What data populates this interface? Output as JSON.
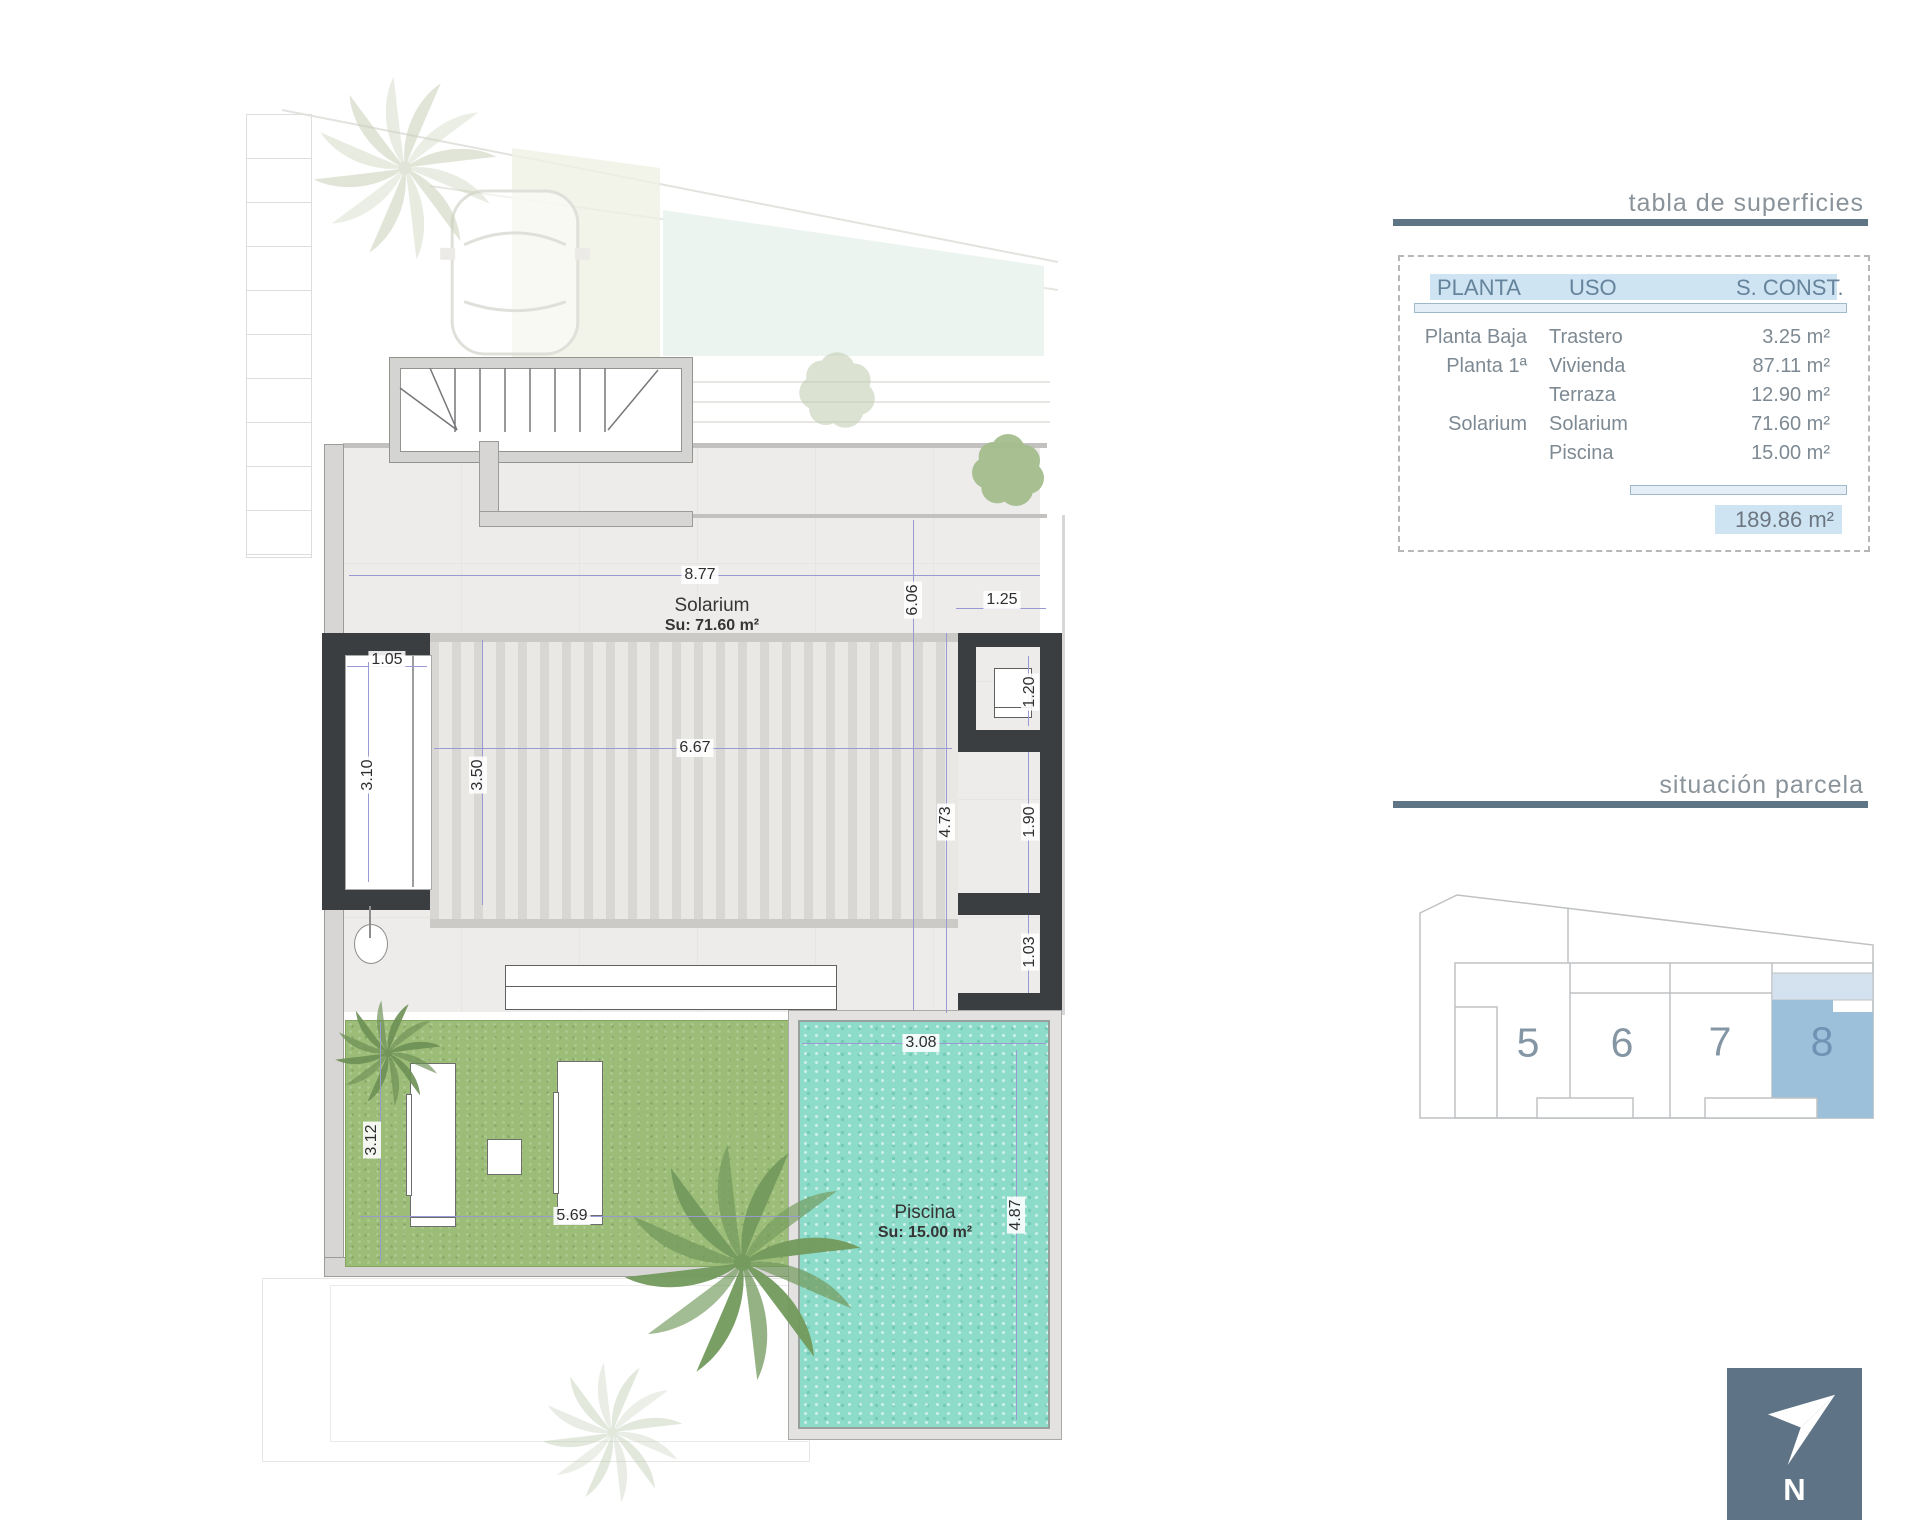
{
  "floor_plan": {
    "solarium_label": "Solarium",
    "solarium_area": "Su: 71.60 m²",
    "piscina_label": "Piscina",
    "piscina_area": "Su: 15.00 m²",
    "dimensions": {
      "top_width": "8.77",
      "pergola_width": "6.67",
      "niche_width": "1.05",
      "niche_height": "3.10",
      "pergola_height": "3.50",
      "right_total_height": "6.06",
      "store_width": "1.25",
      "store_height": "1.20",
      "opening_mid": "1.90",
      "right_inner_height": "4.73",
      "opening_low": "1.03",
      "grass_height": "3.12",
      "grass_width": "5.69",
      "pool_width": "3.08",
      "pool_height": "4.87"
    }
  },
  "surfaces_table": {
    "title": "tabla de superficies",
    "headers": [
      "PLANTA",
      "USO",
      "S. CONST."
    ],
    "rows": [
      {
        "planta": "Planta Baja",
        "uso": "Trastero",
        "sconst": "3.25 m²"
      },
      {
        "planta": "Planta 1ª",
        "uso": "Vivienda",
        "sconst": "87.11 m²"
      },
      {
        "planta": "",
        "uso": "Terraza",
        "sconst": "12.90 m²"
      },
      {
        "planta": "Solarium",
        "uso": "Solarium",
        "sconst": "71.60 m²"
      },
      {
        "planta": "",
        "uso": "Piscina",
        "sconst": "15.00 m²"
      }
    ],
    "total": "189.86 m²"
  },
  "site_plan": {
    "title": "situación parcela",
    "plots": [
      "5",
      "6",
      "7",
      "8"
    ],
    "highlighted_plot": "8"
  },
  "compass": {
    "label": "N"
  },
  "colors": {
    "accent_rule": "#5d7584",
    "table_highlight": "#cfe4f2",
    "plot_highlight": "#9cc0da",
    "pool": "#8ddcca",
    "grass": "#9cbd78",
    "wall_dark": "#3b3e40",
    "north_box": "#5e7486",
    "dim_line": "#9a9ad2"
  }
}
